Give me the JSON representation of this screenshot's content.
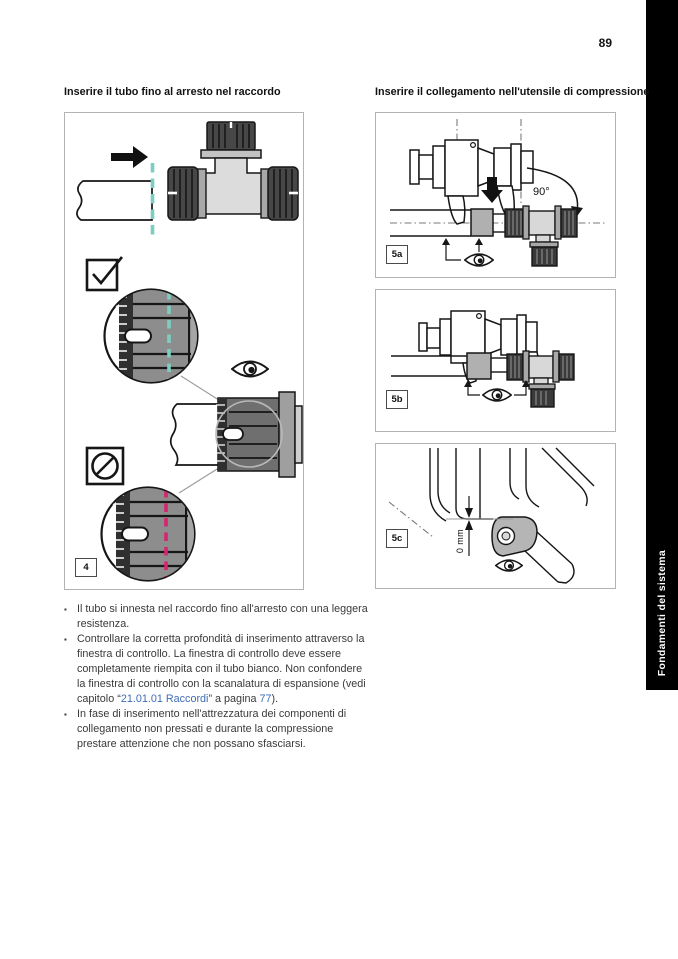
{
  "page": {
    "number": "89",
    "sidebar_tab": "Fondamenti del sistema",
    "bullet_marker": "▪"
  },
  "left_column": {
    "heading": "Inserire il tubo fino al arresto nel raccordo",
    "figure": {
      "label": "4",
      "icons": [
        "arrow-right-icon",
        "checkbox-checked-icon",
        "eye-icon",
        "prohibited-icon"
      ],
      "colors": {
        "insert_depth_ok_dash": "#7ccfc0",
        "insert_depth_wrong_dash": "#d6246e"
      }
    },
    "bullets": [
      {
        "text": "Il tubo si innesta nel raccordo fino all'arresto con una leggera resistenza."
      },
      {
        "pre": "Controllare la corretta profondità di inserimento attraverso la finestra di controllo. La finestra di controllo deve essere completamente riempita con il tubo bianco. Non confondere la finestra di controllo con la scanalatura di espansione (vedi capitolo “",
        "link_chapter": "21.01.01 Raccordi",
        "mid": "” a pagina ",
        "link_page": "77",
        "post": ")."
      },
      {
        "text": "In fase di inserimento nell'attrezzatura dei componenti di collegamento non pressati e durante la compressione prestare attenzione che non possano sfasciarsi."
      }
    ]
  },
  "right_column": {
    "heading": "Inserire il collegamento nell'utensile di compressione",
    "figures": [
      {
        "label": "5a",
        "annotation": "90°",
        "icons": [
          "eye-icon",
          "arrow-down-icon",
          "rotate-arc-icon"
        ]
      },
      {
        "label": "5b",
        "annotation": "",
        "icons": [
          "eye-icon"
        ]
      },
      {
        "label": "5c",
        "annotation": "0 mm",
        "icons": [
          "eye-icon"
        ]
      }
    ]
  },
  "colors": {
    "tab_background": "#000000",
    "link_blue": "#3e6db5",
    "figure_border": "#b3b3b3"
  }
}
